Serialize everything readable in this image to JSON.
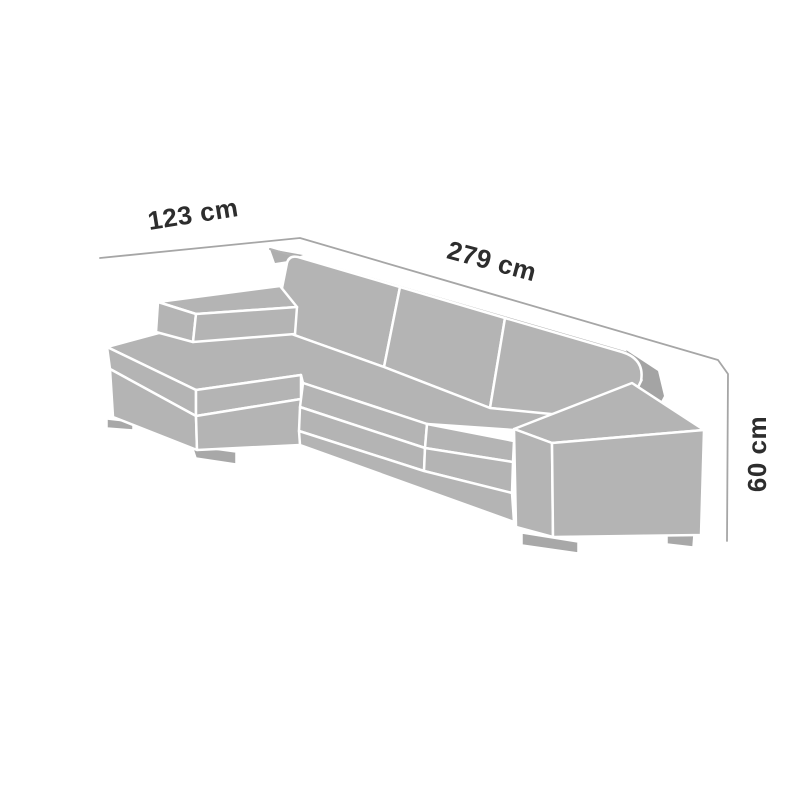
{
  "diagram": {
    "subject": "sectional-sofa-with-chaise-dimension-drawing",
    "labels": {
      "chaise_depth": "123 cm",
      "width": "279 cm",
      "height": "60 cm"
    },
    "colors": {
      "background": "#ffffff",
      "sofa_fill": "#b4b4b4",
      "sofa_back_shadow": "#a4a4a4",
      "foot_fill": "#a8a8a8",
      "seam_stroke": "#ffffff",
      "dimension_line": "#a6a6a6",
      "label_text": "#2d2d2d"
    }
  }
}
